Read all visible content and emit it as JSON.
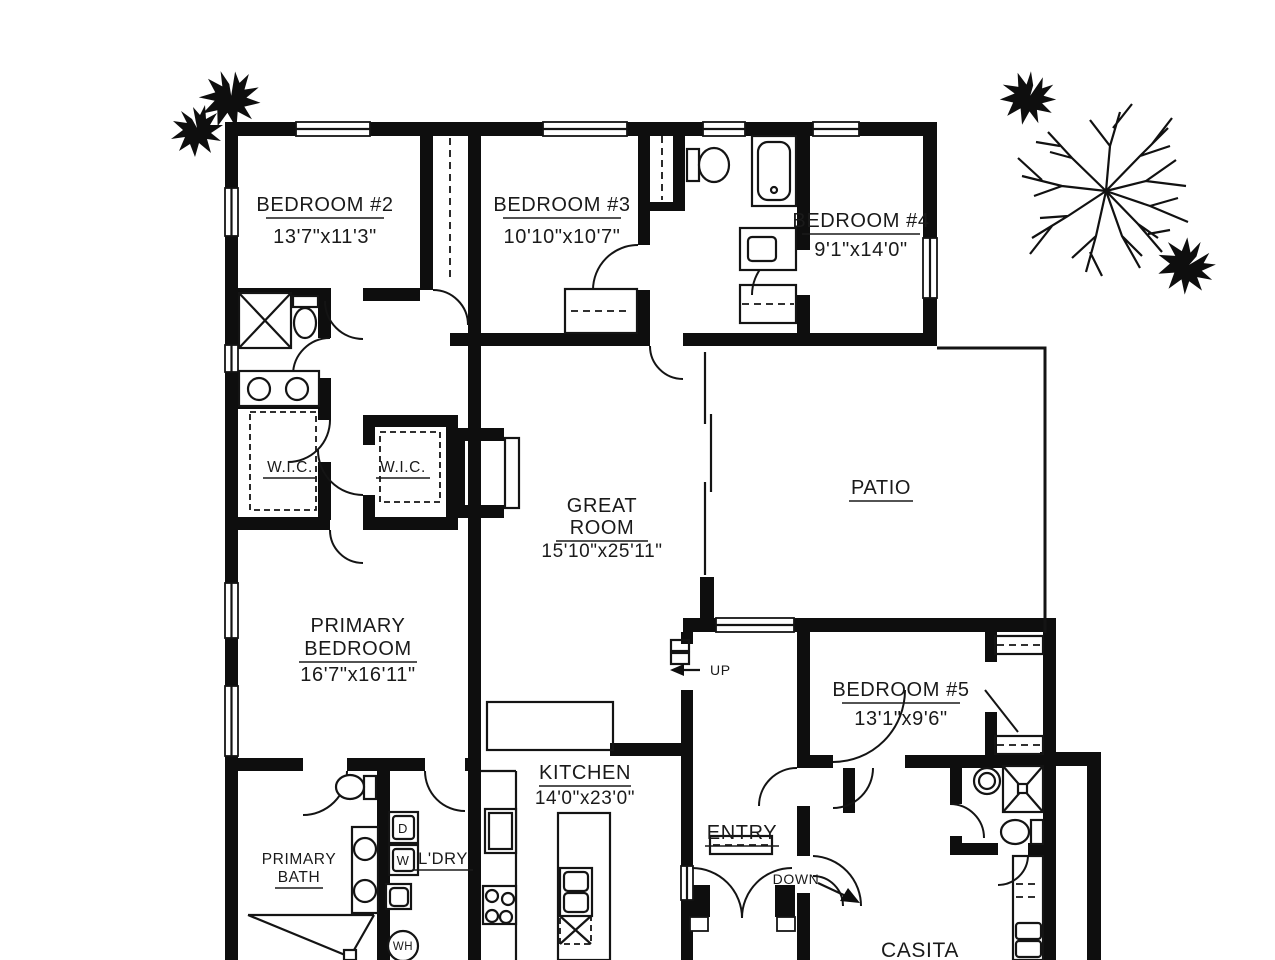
{
  "rooms": [
    {
      "name": "BEDROOM #2",
      "dims": "13'7\"x11'3\""
    },
    {
      "name": "BEDROOM #3",
      "dims": "10'10\"x10'7\""
    },
    {
      "name": "BEDROOM #4",
      "dims": "9'1\"x14'0\""
    },
    {
      "name": "W.I.C."
    },
    {
      "name": "W.I.C."
    },
    {
      "line1": "GREAT",
      "line2": "ROOM",
      "dims": "15'10\"x25'11\""
    },
    {
      "name": "PATIO"
    },
    {
      "line1": "PRIMARY",
      "line2": "BEDROOM",
      "dims": "16'7\"x16'11\""
    },
    {
      "name": "BEDROOM #5",
      "dims": "13'1\"x9'6\""
    },
    {
      "name": "KITCHEN",
      "dims": "14'0\"x23'0\""
    },
    {
      "name": "ENTRY"
    },
    {
      "line1": "PRIMARY",
      "line2": "BATH"
    },
    {
      "name": "L'DRY"
    },
    {
      "name": "CASITA"
    }
  ],
  "annotations": {
    "up": "UP",
    "down": "DOWN",
    "dryer": "D",
    "washer": "W",
    "water_heater": "WH"
  }
}
